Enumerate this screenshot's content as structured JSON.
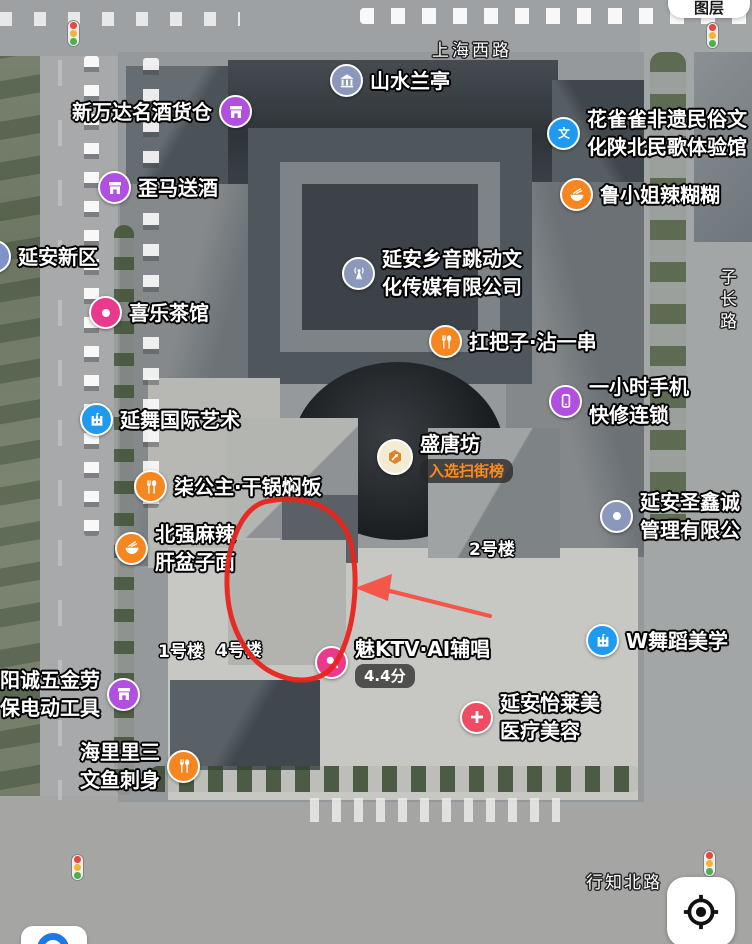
{
  "controls": {
    "layers_label": "图层"
  },
  "roads": {
    "top_label": "上海西路",
    "right_label": "子长路",
    "bottom_label": "行知北路"
  },
  "building_labels": {
    "b1": "1号楼",
    "b4": "4号楼",
    "b2": "2号楼"
  },
  "pois": [
    {
      "name": "山水兰亭",
      "lines": [
        "山水兰亭"
      ],
      "icon": "pavilion-icon",
      "color": "#8b97bb"
    },
    {
      "name": "新万达名酒货仓",
      "lines": [
        "新万达名酒货仓"
      ],
      "icon": "shop-icon",
      "color": "#b14fe0"
    },
    {
      "name": "花雀雀非遗民俗文化陕北民歌体验馆",
      "lines": [
        "花雀雀非遗民俗文",
        "化陕北民歌体验馆"
      ],
      "icon": "culture-wen-icon",
      "color": "#1e9af0"
    },
    {
      "name": "歪马送酒",
      "lines": [
        "歪马送酒"
      ],
      "icon": "shop-icon",
      "color": "#b14fe0"
    },
    {
      "name": "鲁小姐辣糊糊",
      "lines": [
        "鲁小姐辣糊糊"
      ],
      "icon": "bowl-icon",
      "color": "#f6861f"
    },
    {
      "name": "延安新区",
      "lines": [
        "延安新区"
      ],
      "icon": "district-icon",
      "color": "#7f92c9"
    },
    {
      "name": "延安乡音跳动文化传媒有限公司",
      "lines": [
        "延安乡音跳动文",
        "化传媒有限公司"
      ],
      "icon": "radio-tower-icon",
      "color": "#8b97bb"
    },
    {
      "name": "喜乐茶馆",
      "lines": [
        "喜乐茶馆"
      ],
      "icon": "dot-icon",
      "color": "#e93a8d"
    },
    {
      "name": "扛把子·沾一串",
      "lines": [
        "扛把子·沾一串"
      ],
      "icon": "utensils-icon",
      "color": "#f6861f"
    },
    {
      "name": "一小时手机快修连锁",
      "lines": [
        "一小时手机",
        "快修连锁"
      ],
      "icon": "phone-icon",
      "color": "#b14fe0"
    },
    {
      "name": "延舞国际艺术",
      "lines": [
        "延舞国际艺术"
      ],
      "icon": "art-venue-icon",
      "color": "#1e9af0"
    },
    {
      "name": "盛唐坊",
      "lines": [
        "盛唐坊"
      ],
      "icon": "hex-arrow-icon",
      "color": "#f3ecd2",
      "badge": "入选扫街榜"
    },
    {
      "name": "延安圣鑫诚管理有限公",
      "lines": [
        "延安圣鑫诚",
        "管理有限公"
      ],
      "icon": "dot-icon",
      "color": "#8b97bb"
    },
    {
      "name": "柒公主·干锅焖饭",
      "lines": [
        "柒公主·干锅焖饭"
      ],
      "icon": "utensils-icon",
      "color": "#f6861f"
    },
    {
      "name": "北强麻辣肝盆子面",
      "lines": [
        "北强麻辣",
        "肝盆子面"
      ],
      "icon": "bowl-icon",
      "color": "#f6861f"
    },
    {
      "name": "魅KTV·AI辅唱",
      "lines": [
        "魅KTV·AI辅唱"
      ],
      "icon": "mic-icon",
      "color": "#e93a8d",
      "rating": "4.4分"
    },
    {
      "name": "W舞蹈美学",
      "lines": [
        "W舞蹈美学"
      ],
      "icon": "art-venue-icon",
      "color": "#1e9af0"
    },
    {
      "name": "阳诚五金劳保电动工具",
      "lines": [
        "阳诚五金劳",
        "保电动工具"
      ],
      "icon": "shop-icon",
      "color": "#b14fe0"
    },
    {
      "name": "延安怡莱美医疗美容",
      "lines": [
        "延安怡莱美",
        "医疗美容"
      ],
      "icon": "medical-plus-icon",
      "color": "#ef4b63"
    },
    {
      "name": "海里里三文鱼刺身",
      "lines": [
        "海里里三",
        "文鱼刺身"
      ],
      "icon": "utensils-icon",
      "color": "#f6861f"
    }
  ],
  "annotation": {
    "circle_color": "#e8241c",
    "arrow_color": "#f2574a"
  }
}
